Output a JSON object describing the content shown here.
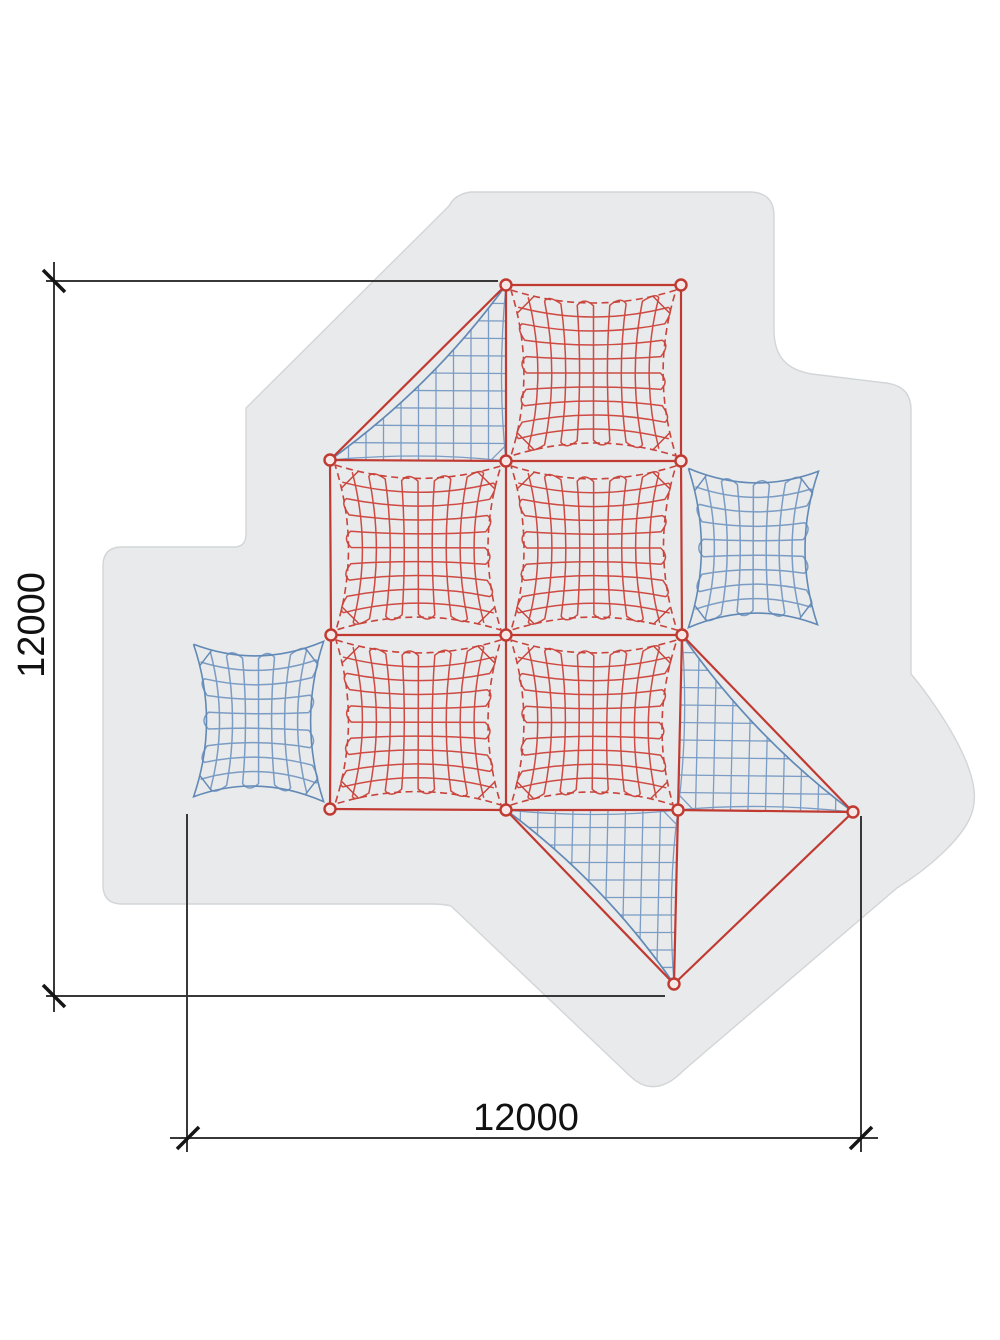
{
  "title": "climbing-net-plan-view",
  "dims": {
    "vertical": {
      "label": "12000"
    },
    "horizontal": {
      "label": "12000"
    }
  },
  "colors": {
    "background": "#ffffff",
    "safety_area_fill": "#e8eaeb",
    "safety_area_edge": "#d2d6d8",
    "rope_red": "#c13a32",
    "net_red": "#ce4a42",
    "net_red_border": "#c8433b",
    "net_blue": "#7b9cc4",
    "net_blue_border": "#6289b6",
    "node_fill": "#f6e8e6",
    "dim_line": "#383838",
    "dim_tick": "#151515",
    "dim_text": "#111111"
  },
  "diagram": {
    "safety_area_path": "M 471,192 L 749,192 Q 774,192 774,216 L 774,330 C 774,358 788,370 812,374 L 886,383 Q 911,386 911,410 L 911,674 C 923,688 948,722 962,752 C 976,782 978,802 969,820 C 959,840 932,866 897,888 L 684,1070 Q 655,1100 630,1076 L 451,906 Q 443,904 432,904 L 122,904 Q 103,904 103,885 L 103,566 Q 103,547 122,547 L 234,547 Q 246,547 246,534 L 246,408 L 449,206 Q 455,194 471,192 Z",
    "nodes": [
      [
        506,
        285
      ],
      [
        681,
        285
      ],
      [
        330,
        460
      ],
      [
        506,
        461
      ],
      [
        681,
        461
      ],
      [
        331,
        635
      ],
      [
        506,
        635
      ],
      [
        682,
        635
      ],
      [
        330,
        809
      ],
      [
        506,
        810
      ],
      [
        678,
        810
      ],
      [
        853,
        812
      ],
      [
        674,
        984
      ]
    ],
    "ropes": [
      [
        0,
        1
      ],
      [
        2,
        3
      ],
      [
        3,
        4
      ],
      [
        5,
        6
      ],
      [
        6,
        7
      ],
      [
        8,
        9
      ],
      [
        9,
        10
      ],
      [
        10,
        11
      ],
      [
        0,
        3
      ],
      [
        3,
        6
      ],
      [
        6,
        9
      ],
      [
        1,
        4
      ],
      [
        4,
        7
      ],
      [
        2,
        5
      ],
      [
        5,
        8
      ],
      [
        7,
        10
      ],
      [
        0,
        2
      ],
      [
        7,
        11
      ],
      [
        11,
        12
      ],
      [
        10,
        12
      ],
      [
        9,
        12
      ]
    ],
    "red_squares": [
      [
        0,
        1,
        4,
        3
      ],
      [
        2,
        3,
        6,
        5
      ],
      [
        3,
        4,
        7,
        6
      ],
      [
        5,
        6,
        9,
        8
      ],
      [
        6,
        7,
        10,
        9
      ]
    ],
    "blue_squares": [
      [
        [
          189,
          639
        ],
        [
          328,
          636
        ],
        [
          328,
          807
        ],
        [
          189,
          802
        ]
      ],
      [
        [
          684,
          463
        ],
        [
          823,
          466
        ],
        [
          822,
          630
        ],
        [
          684,
          633
        ]
      ]
    ],
    "blue_triangles": [
      {
        "a": [
          506,
          285
        ],
        "b": [
          330,
          460
        ],
        "c": [
          506,
          461
        ]
      },
      {
        "a": [
          682,
          635
        ],
        "b": [
          853,
          812
        ],
        "c": [
          678,
          810
        ]
      },
      {
        "a": [
          506,
          810
        ],
        "b": [
          674,
          984
        ],
        "c": [
          678,
          810
        ]
      }
    ],
    "dim_vertical": {
      "line": [
        54,
        262,
        54,
        1012
      ],
      "ticks": [
        [
          54,
          281
        ],
        [
          54,
          996
        ]
      ],
      "ext": [
        [
          46,
          281,
          498,
          281
        ],
        [
          46,
          996,
          665,
          996
        ]
      ],
      "label_pos": [
        44,
        625
      ]
    },
    "dim_horizontal": {
      "line": [
        170,
        1138,
        878,
        1138
      ],
      "ticks": [
        [
          188,
          1138
        ],
        [
          861,
          1138
        ]
      ],
      "ext": [
        [
          187,
          814,
          187,
          1152
        ],
        [
          861,
          816,
          861,
          1152
        ]
      ],
      "label_pos": [
        526,
        1130
      ]
    }
  }
}
